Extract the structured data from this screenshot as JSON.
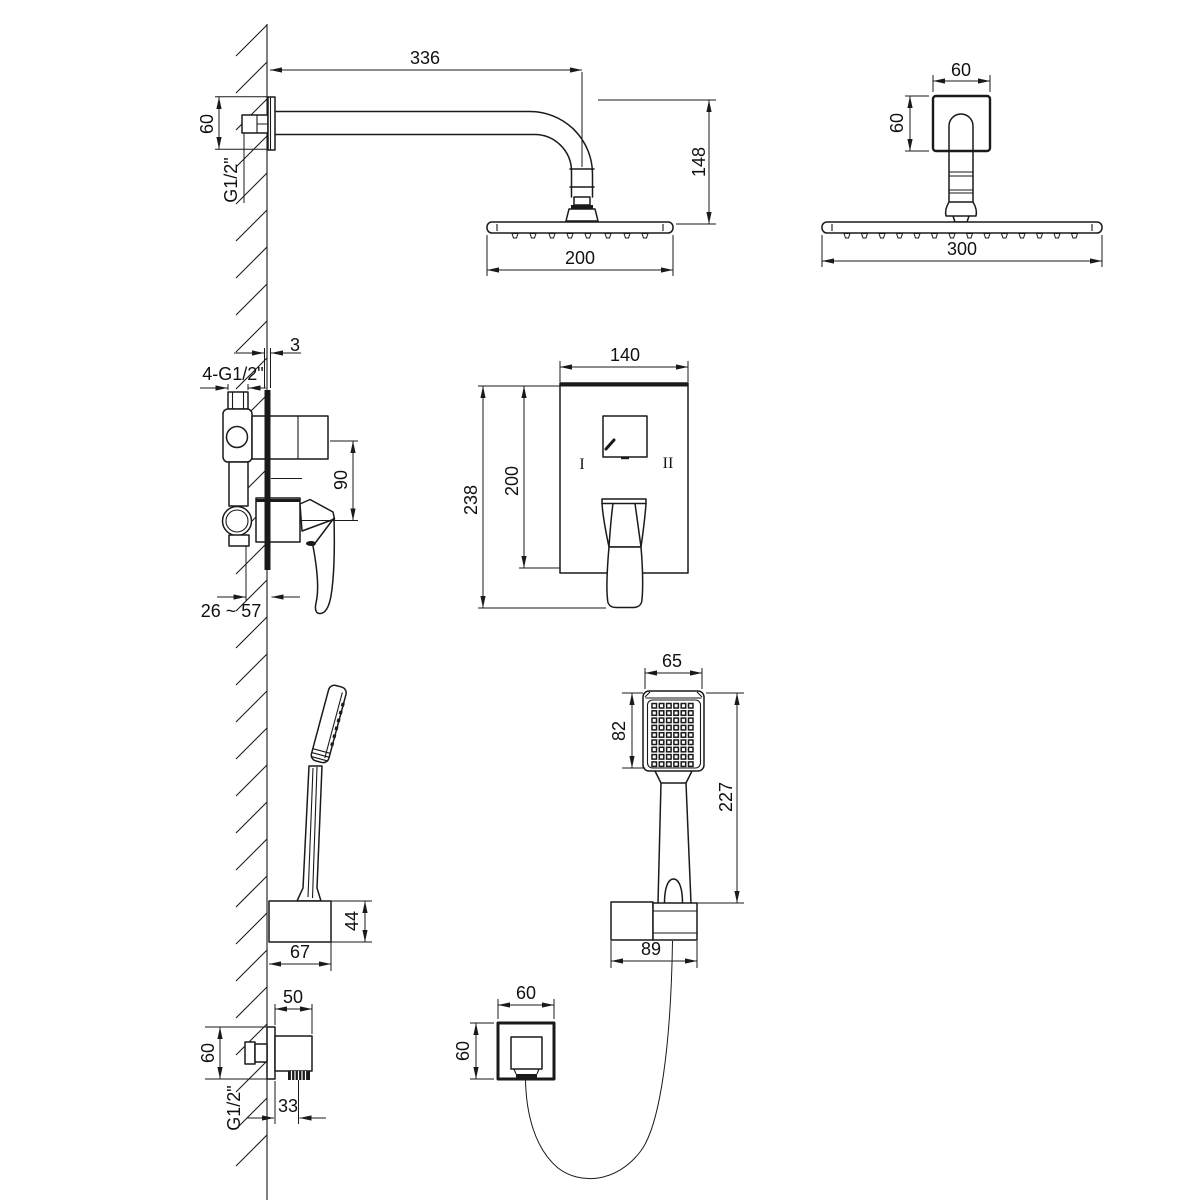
{
  "drawing": {
    "type": "technical-dimension-drawing",
    "subject": "concealed shower set installation drawing",
    "colors": {
      "line": "#1a1a1a",
      "background": "#ffffff"
    },
    "views": {
      "arm_side": {
        "len": "336",
        "flange": "60",
        "thread": "G1/2\"",
        "height": "148",
        "head": "200"
      },
      "arm_front": {
        "width": "60",
        "height": "60",
        "head": "300"
      },
      "mixer_side": {
        "plate": "3",
        "ports": "4-G1/2\"",
        "gap": "90",
        "depth": "26 ~ 57"
      },
      "mixer_front": {
        "width": "140",
        "plate": "200",
        "total": "238",
        "left": "I",
        "right": "II"
      },
      "hand_wall": {
        "holder_h": "44",
        "holder_d": "67"
      },
      "hand_front": {
        "head": "65",
        "face": "82",
        "total": "227",
        "holder": "89"
      },
      "outlet_side": {
        "depth": "50",
        "height": "60",
        "thread": "G1/2\"",
        "offset": "33"
      },
      "outlet_front": {
        "width": "60",
        "height": "60"
      }
    }
  }
}
